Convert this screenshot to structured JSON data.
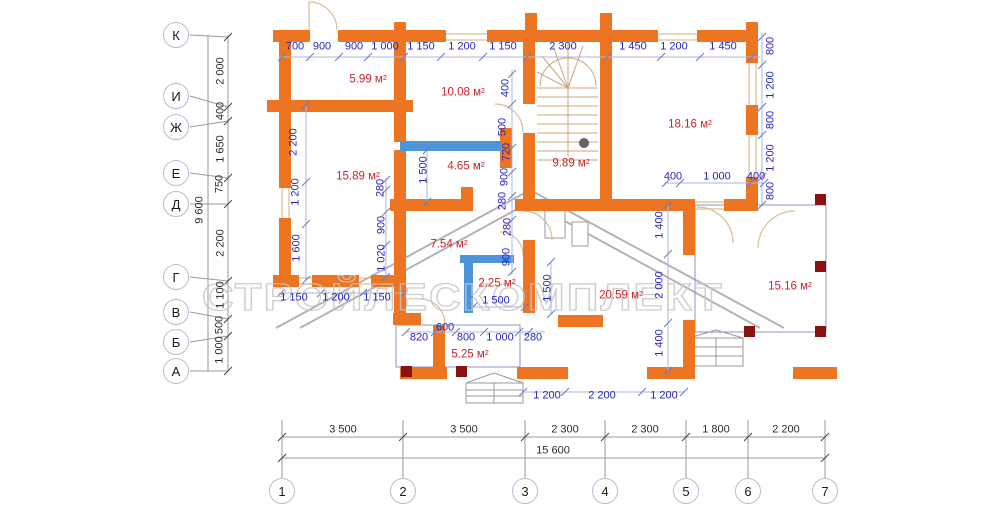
{
  "watermark": "СТРОЙЛЕСКОМПЛЕКТ",
  "colors": {
    "wall_orange": "#ED7521",
    "window_blue": "#4D94DB",
    "dim_blue": "#2626BE",
    "room_red": "#C8242C",
    "post_dark_red": "#8C1212",
    "grid_circle": "#B9BCD8"
  },
  "totals": {
    "width": "15 600",
    "height": "9 600"
  },
  "dims_blue": [
    {
      "t": "700",
      "x": 295,
      "y": 47
    },
    {
      "t": "900",
      "x": 322,
      "y": 47
    },
    {
      "t": "900",
      "x": 354,
      "y": 47
    },
    {
      "t": "1 000",
      "x": 385,
      "y": 47
    },
    {
      "t": "1 150",
      "x": 421,
      "y": 47
    },
    {
      "t": "1 200",
      "x": 462,
      "y": 47
    },
    {
      "t": "1 150",
      "x": 503,
      "y": 47
    },
    {
      "t": "2 300",
      "x": 563,
      "y": 47
    },
    {
      "t": "1 450",
      "x": 633,
      "y": 47
    },
    {
      "t": "1 200",
      "x": 674,
      "y": 47
    },
    {
      "t": "1 450",
      "x": 723,
      "y": 47
    },
    {
      "t": "400",
      "x": 673,
      "y": 177
    },
    {
      "t": "1 000",
      "x": 717,
      "y": 177
    },
    {
      "t": "400",
      "x": 756,
      "y": 177
    },
    {
      "t": "1 150",
      "x": 294,
      "y": 298
    },
    {
      "t": "1 200",
      "x": 336,
      "y": 298
    },
    {
      "t": "1 150",
      "x": 377,
      "y": 298
    },
    {
      "t": "600",
      "x": 445,
      "y": 328
    },
    {
      "t": "820",
      "x": 419,
      "y": 338
    },
    {
      "t": "800",
      "x": 466,
      "y": 338
    },
    {
      "t": "1 000",
      "x": 500,
      "y": 338
    },
    {
      "t": "280",
      "x": 533,
      "y": 338
    },
    {
      "t": "1 200",
      "x": 547,
      "y": 396
    },
    {
      "t": "2 200",
      "x": 602,
      "y": 396
    },
    {
      "t": "1 200",
      "x": 664,
      "y": 396
    },
    {
      "t": "1 500",
      "x": 496,
      "y": 301
    },
    {
      "t": "2 200",
      "x": 294,
      "y": 142,
      "r": 1
    },
    {
      "t": "1 200",
      "x": 296,
      "y": 192,
      "r": 1
    },
    {
      "t": "1 600",
      "x": 297,
      "y": 248,
      "r": 1
    },
    {
      "t": "280",
      "x": 381,
      "y": 188,
      "r": 1
    },
    {
      "t": "900",
      "x": 382,
      "y": 225,
      "r": 1
    },
    {
      "t": "1 020",
      "x": 382,
      "y": 258,
      "r": 1
    },
    {
      "t": "1 500",
      "x": 424,
      "y": 170,
      "r": 1
    },
    {
      "t": "400",
      "x": 506,
      "y": 88,
      "r": 1
    },
    {
      "t": "500",
      "x": 503,
      "y": 127,
      "r": 1
    },
    {
      "t": "720",
      "x": 507,
      "y": 152,
      "r": 1
    },
    {
      "t": "900",
      "x": 505,
      "y": 177,
      "r": 1
    },
    {
      "t": "280",
      "x": 503,
      "y": 201,
      "r": 1
    },
    {
      "t": "280",
      "x": 508,
      "y": 227,
      "r": 1
    },
    {
      "t": "900",
      "x": 507,
      "y": 257,
      "r": 1
    },
    {
      "t": "1 500",
      "x": 548,
      "y": 288,
      "r": 1
    },
    {
      "t": "1 400",
      "x": 660,
      "y": 225,
      "r": 1
    },
    {
      "t": "2 000",
      "x": 660,
      "y": 285,
      "r": 1
    },
    {
      "t": "1 400",
      "x": 660,
      "y": 343,
      "r": 1
    },
    {
      "t": "800",
      "x": 771,
      "y": 46,
      "r": 1
    },
    {
      "t": "1 200",
      "x": 771,
      "y": 85,
      "r": 1
    },
    {
      "t": "800",
      "x": 771,
      "y": 120,
      "r": 1
    },
    {
      "t": "1 200",
      "x": 771,
      "y": 158,
      "r": 1
    },
    {
      "t": "800",
      "x": 771,
      "y": 191,
      "r": 1
    }
  ],
  "dims_black": [
    {
      "t": "9 600",
      "x": 200,
      "y": 210,
      "r": 1
    },
    {
      "t": "2 000",
      "x": 221,
      "y": 71,
      "r": 1
    },
    {
      "t": "400",
      "x": 221,
      "y": 111,
      "r": 1
    },
    {
      "t": "1 650",
      "x": 221,
      "y": 149,
      "r": 1
    },
    {
      "t": "750",
      "x": 220,
      "y": 184,
      "r": 1
    },
    {
      "t": "2 200",
      "x": 221,
      "y": 243,
      "r": 1
    },
    {
      "t": "1 100",
      "x": 221,
      "y": 295,
      "r": 1
    },
    {
      "t": "500",
      "x": 220,
      "y": 325,
      "r": 1
    },
    {
      "t": "1 000",
      "x": 220,
      "y": 350,
      "r": 1
    },
    {
      "t": "3 500",
      "x": 343,
      "y": 430
    },
    {
      "t": "3 500",
      "x": 464,
      "y": 430
    },
    {
      "t": "2 300",
      "x": 565,
      "y": 430
    },
    {
      "t": "2 300",
      "x": 645,
      "y": 430
    },
    {
      "t": "1 800",
      "x": 716,
      "y": 430
    },
    {
      "t": "2 200",
      "x": 786,
      "y": 430
    },
    {
      "t": "15 600",
      "x": 553,
      "y": 451
    }
  ],
  "room_areas": [
    {
      "t": "5.99 м²",
      "x": 368,
      "y": 80
    },
    {
      "t": "10.08 м²",
      "x": 463,
      "y": 93
    },
    {
      "t": "18.16 м²",
      "x": 690,
      "y": 125
    },
    {
      "t": "15.89 м²",
      "x": 358,
      "y": 177
    },
    {
      "t": "4.65 м²",
      "x": 466,
      "y": 167
    },
    {
      "t": "9.89 м²",
      "x": 571,
      "y": 164
    },
    {
      "t": "7.54 м²",
      "x": 449,
      "y": 245
    },
    {
      "t": "2.25 м²",
      "x": 497,
      "y": 284
    },
    {
      "t": "20.59 м²",
      "x": 621,
      "y": 296
    },
    {
      "t": "15.16 м²",
      "x": 790,
      "y": 287
    },
    {
      "t": "5.25 м²",
      "x": 470,
      "y": 355
    }
  ],
  "grid_rows": [
    {
      "t": "К",
      "x": 176,
      "y": 35,
      "n": "grid-row-K"
    },
    {
      "t": "И",
      "x": 176,
      "y": 96,
      "n": "grid-row-I"
    },
    {
      "t": "Ж",
      "x": 176,
      "y": 127,
      "n": "grid-row-Zh"
    },
    {
      "t": "Е",
      "x": 176,
      "y": 173,
      "n": "grid-row-E"
    },
    {
      "t": "Д",
      "x": 176,
      "y": 204,
      "n": "grid-row-D"
    },
    {
      "t": "Г",
      "x": 176,
      "y": 277,
      "n": "grid-row-G"
    },
    {
      "t": "В",
      "x": 176,
      "y": 312,
      "n": "grid-row-V"
    },
    {
      "t": "Б",
      "x": 176,
      "y": 342,
      "n": "grid-row-B"
    },
    {
      "t": "А",
      "x": 176,
      "y": 371,
      "n": "grid-row-A"
    }
  ],
  "grid_cols": [
    {
      "t": "1",
      "x": 282,
      "y": 491,
      "n": "grid-col-1"
    },
    {
      "t": "2",
      "x": 403,
      "y": 491,
      "n": "grid-col-2"
    },
    {
      "t": "3",
      "x": 525,
      "y": 491,
      "n": "grid-col-3"
    },
    {
      "t": "4",
      "x": 605,
      "y": 491,
      "n": "grid-col-4"
    },
    {
      "t": "5",
      "x": 686,
      "y": 491,
      "n": "grid-col-5"
    },
    {
      "t": "6",
      "x": 748,
      "y": 491,
      "n": "grid-col-6"
    },
    {
      "t": "7",
      "x": 825,
      "y": 491,
      "n": "grid-col-7"
    }
  ]
}
